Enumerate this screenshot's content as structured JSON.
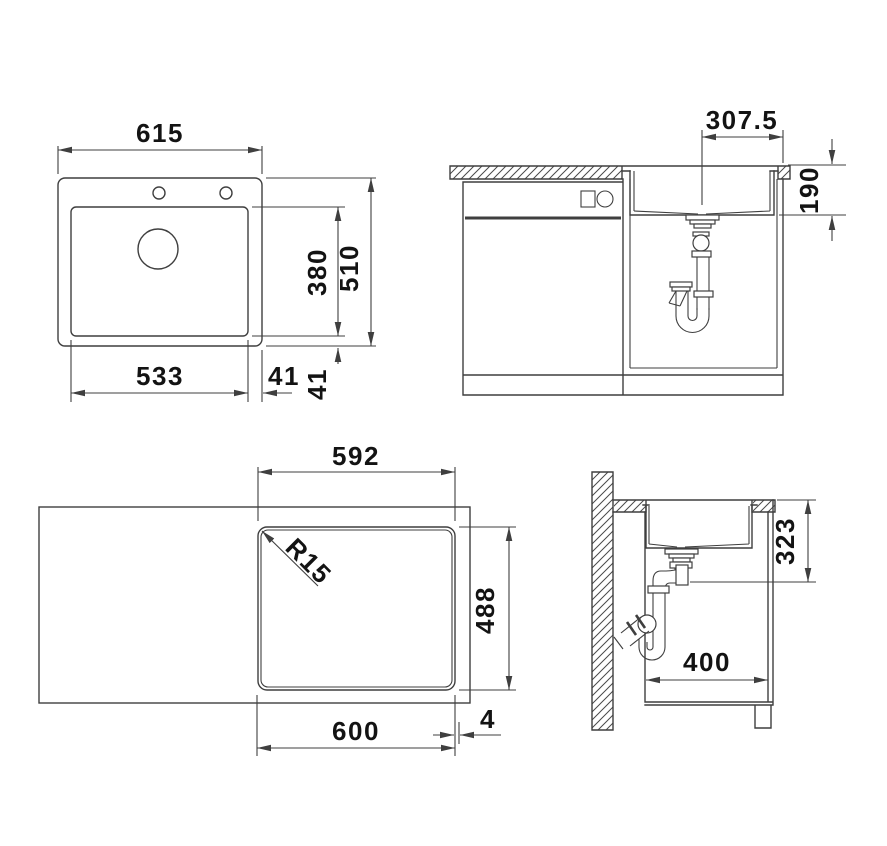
{
  "title": "Sink installation technical drawing",
  "colors": {
    "line": "#3f3f3f",
    "text": "#131313",
    "background": "#ffffff"
  },
  "views": {
    "top_plan": {
      "overall_width": "615",
      "overall_depth": "510",
      "bowl_depth": "380",
      "bowl_width": "533",
      "gap_right": "41",
      "gap_bottom": "41"
    },
    "front_section": {
      "drain_offset": "307.5",
      "bowl_height": "190"
    },
    "bottom_plan": {
      "cutout_width": "592",
      "corner_radius": "R15",
      "cutout_depth": "488",
      "bowl_outer_width": "600",
      "edge_offset": "4"
    },
    "side_section": {
      "mount_height": "323",
      "cabinet_clearance": "400"
    }
  }
}
